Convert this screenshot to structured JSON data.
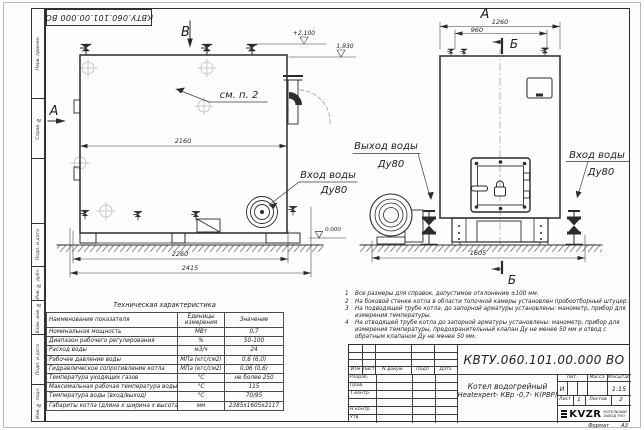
{
  "doc": {
    "number": "КВТУ.060.101.00.000  ВО",
    "format_label": "Формат",
    "format_value": "А3"
  },
  "frame_strip": {
    "c1": "Перв. примен.",
    "c2": "Справ. №",
    "c3": "",
    "c4": "Подп. и дата",
    "c5": "Инв. № дубл.",
    "c6": "Взам. инв. №",
    "c7": "Подп. и дата",
    "c8": "Инв. № подл."
  },
  "views": {
    "side": {
      "view_label": "А",
      "plane_label": "В",
      "see_note": "см. п. 2",
      "elev_top": "+2,100",
      "elev_pipe": "1,930",
      "elev_zero": "0.000",
      "dim_width": "2160",
      "dim_base": "2260",
      "dim_overall": "2415",
      "inlet1": "Вход воды",
      "inlet2": "Ду80",
      "outlet1": "Выход воды",
      "outlet2": "Ду80"
    },
    "front": {
      "view_label": "А",
      "section_top": "Б",
      "section_bottom": "Б",
      "dim_top": "1260",
      "dim_inner": "960",
      "dim_base": "1605",
      "inlet1": "Вход воды",
      "inlet2": "Ду80"
    }
  },
  "tech_table": {
    "title": "Техническая характеристика",
    "col_name": "Наименование показателя",
    "col_units1": "Единицы",
    "col_units2": "измерения",
    "col_value": "Значение",
    "rows": [
      {
        "name": "Номинальная мощность",
        "units": "МВт",
        "value": "0,7"
      },
      {
        "name": "Диапазон рабочего регулирования",
        "units": "%",
        "value": "50-100"
      },
      {
        "name": "Расход воды",
        "units": "м3/ч",
        "value": "24"
      },
      {
        "name": "Рабочее давление воды",
        "units": "МПа (кгс/см2)",
        "value": "0,6 (6,0)"
      },
      {
        "name": "Гидравлическое сопротивление котла",
        "units": "МПа (кгс/см2)",
        "value": "0,06 (0,6)"
      },
      {
        "name": "Температура уходящих газов",
        "units": "°С",
        "value": "не более 250"
      },
      {
        "name": "Максимальная рабочая температура воды",
        "units": "°С",
        "value": "115"
      },
      {
        "name": "Температура воды (вход/выход)",
        "units": "°С",
        "value": "70/95"
      },
      {
        "name": "Габариты котла (длина х ширина х высота)",
        "units": "мм",
        "value": "2385х1605х2117"
      }
    ]
  },
  "notes": [
    {
      "num": "1",
      "text": "Все размеры для справок, допустимое отклонение ±100 мм."
    },
    {
      "num": "2",
      "text": "На боковой стенке котла в области топочной камеры установлен пробоотборный штуцер."
    },
    {
      "num": "3",
      "text": "На  подводящей трубе котла, до запорной арматуры установлены: манометр, прибор для измерения температуры."
    },
    {
      "num": "4",
      "text": "На отводящей трубе котла до запорной арматуры установлены: манометр, прибор для измерения температуры, предохранительный клапан Ду не менее 50 мм и отвод с обратным клапаном Ду не менее 50 мм."
    }
  ],
  "title_block": {
    "doc_number": "КВТУ.060.101.00.000  ВО",
    "rev_headers": {
      "h1": "Изм",
      "h2": "Лист",
      "h3": "N докум.",
      "h4": "Подп",
      "h5": "Дата"
    },
    "roles": {
      "r1": "Разраб.",
      "r2": "Пров.",
      "r3": "Т.контр.",
      "r4": "",
      "r5": "Н.контр.",
      "r6": "Утв."
    },
    "product_line1": "Котел водогрейный",
    "product_line2": "Heatexpert- КВр -0,7- К(РВР)",
    "lit_label": "Лит.",
    "mass_label": "Масса",
    "scale_label": "Масштаб",
    "lit_value": "И",
    "scale_value": "1:15",
    "sheet_label": "Лист",
    "sheet_value": "1",
    "sheets_label": "Листов",
    "sheets_value": "2",
    "logo_text": "KVZR",
    "company_line1": "КОТЕЛЬНЫЙ",
    "company_line2": "ЗАВОД РЭП"
  }
}
